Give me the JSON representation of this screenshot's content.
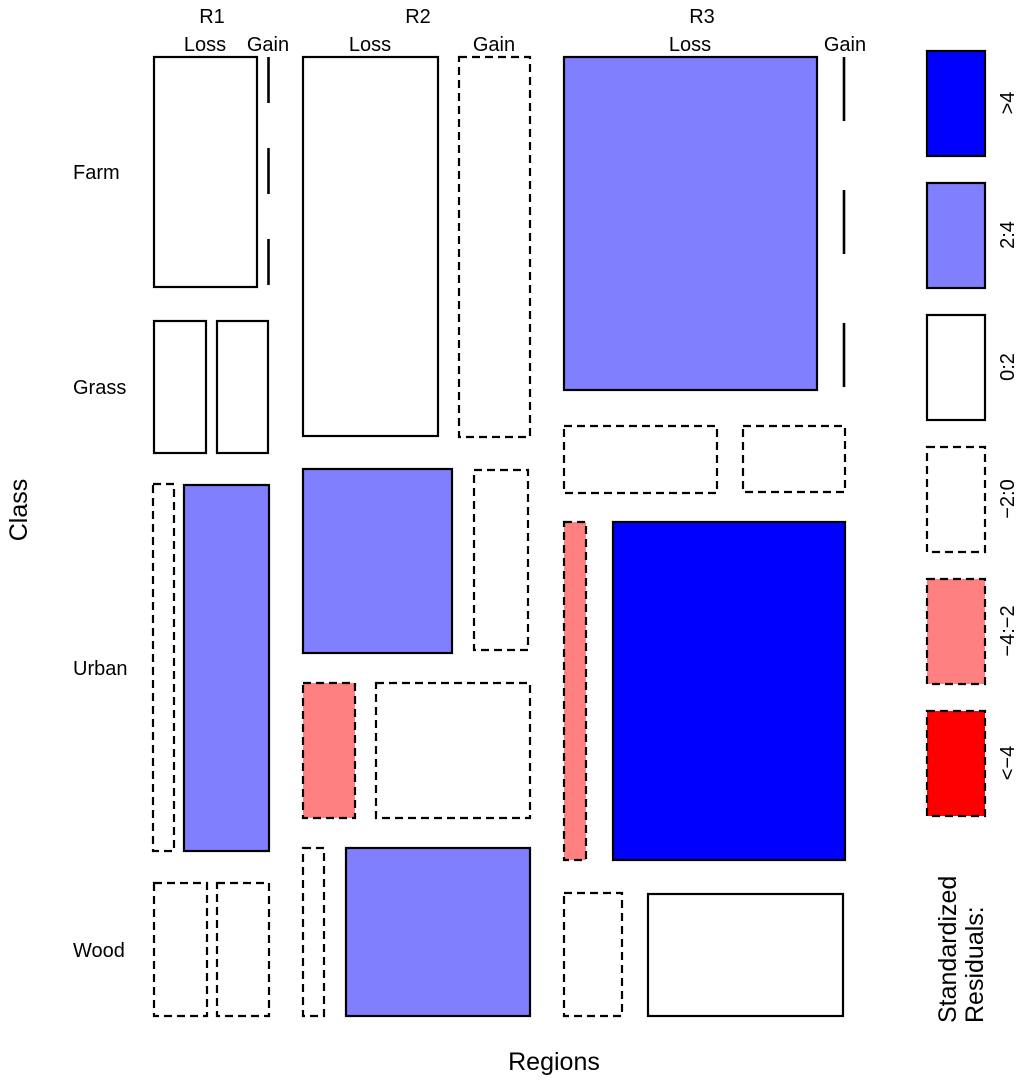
{
  "axes": {
    "x_title": "Regions",
    "y_title": "Class"
  },
  "labels": {
    "columns": [
      {
        "label": "R1",
        "x": 212,
        "y": 23,
        "subs": [
          {
            "label": "Loss",
            "x": 205,
            "y": 51
          },
          {
            "label": "Gain",
            "x": 268,
            "y": 51
          }
        ]
      },
      {
        "label": "R2",
        "x": 418,
        "y": 23,
        "subs": [
          {
            "label": "Loss",
            "x": 370,
            "y": 51
          },
          {
            "label": "Gain",
            "x": 494,
            "y": 51
          }
        ]
      },
      {
        "label": "R3",
        "x": 702,
        "y": 23,
        "subs": [
          {
            "label": "Loss",
            "x": 690,
            "y": 51
          },
          {
            "label": "Gain",
            "x": 845,
            "y": 51
          }
        ]
      }
    ],
    "rows": [
      {
        "label": "Farm",
        "x": 73,
        "y": 179
      },
      {
        "label": "Grass",
        "x": 73,
        "y": 394
      },
      {
        "label": "Urban",
        "x": 73,
        "y": 675
      },
      {
        "label": "Wood",
        "x": 73,
        "y": 957
      }
    ]
  },
  "legend": {
    "title_line1": "Standardized",
    "title_line2": "Residuals:",
    "box_x": 927,
    "box_w": 58,
    "box_h": 105,
    "label_x": 1007,
    "items": [
      {
        "label": ">4",
        "fill": "#0000FF",
        "border": "solid",
        "y": 51,
        "label_cy": 103
      },
      {
        "label": "2:4",
        "fill": "#8080FF",
        "border": "solid",
        "y": 183,
        "label_cy": 235
      },
      {
        "label": "0:2",
        "fill": "#FFFFFF",
        "border": "solid",
        "y": 315,
        "label_cy": 367
      },
      {
        "label": "−2:0",
        "fill": "#FFFFFF",
        "border": "dashed",
        "y": 447,
        "label_cy": 499
      },
      {
        "label": "−4:−2",
        "fill": "#FF8080",
        "border": "dashed",
        "y": 579,
        "label_cy": 631
      },
      {
        "label": "<−4",
        "fill": "#FF0000",
        "border": "dashed",
        "y": 711,
        "label_cy": 763
      }
    ]
  },
  "colors": {
    "residual_gt4": "#0000FF",
    "residual_2_4": "#8080FF",
    "residual_0_2": "#FFFFFF",
    "residual_m2_0": "#FFFFFF",
    "residual_m4_m2": "#FF8080",
    "residual_ltm4": "#FF0000",
    "stroke": "#000000",
    "background": "#FFFFFF"
  },
  "chart_data": {
    "type": "mosaic",
    "x_dimension": "Regions",
    "x_categories": [
      "R1",
      "R2",
      "R3"
    ],
    "sub_categories": [
      "Loss",
      "Gain"
    ],
    "y_dimension": "Class",
    "y_categories": [
      "Farm",
      "Grass",
      "Urban",
      "Wood"
    ],
    "shading": "standardized residuals (solid border = positive, dashed border = negative, long-dash line = zero-width/empty cell)",
    "cells": [
      {
        "region": "R1",
        "class": "Farm",
        "change": "Loss",
        "residual_bin": "0:2",
        "x": 154,
        "y": 57,
        "w": 103,
        "h": 230,
        "fill": "#FFFFFF",
        "border": "solid"
      },
      {
        "region": "R1",
        "class": "Farm",
        "change": "Gain",
        "residual_bin": "zero",
        "zero": true,
        "x": 268.5,
        "y": 57,
        "h": 230,
        "dash": "46 45"
      },
      {
        "region": "R1",
        "class": "Grass",
        "change": "Loss",
        "residual_bin": "0:2",
        "x": 154,
        "y": 321,
        "w": 52,
        "h": 132,
        "fill": "#FFFFFF",
        "border": "solid"
      },
      {
        "region": "R1",
        "class": "Grass",
        "change": "Gain",
        "residual_bin": "0:2",
        "x": 217,
        "y": 321,
        "w": 51,
        "h": 132,
        "fill": "#FFFFFF",
        "border": "solid"
      },
      {
        "region": "R1",
        "class": "Urban",
        "change": "Loss",
        "residual_bin": "−2:0",
        "x": 153,
        "y": 484,
        "w": 21,
        "h": 367,
        "fill": "#FFFFFF",
        "border": "dashed"
      },
      {
        "region": "R1",
        "class": "Urban",
        "change": "Gain",
        "residual_bin": "2:4",
        "x": 184,
        "y": 485,
        "w": 85,
        "h": 366,
        "fill": "#8080FF",
        "border": "solid"
      },
      {
        "region": "R1",
        "class": "Wood",
        "change": "Loss",
        "residual_bin": "−2:0",
        "x": 154,
        "y": 883,
        "w": 53,
        "h": 133,
        "fill": "#FFFFFF",
        "border": "dashed"
      },
      {
        "region": "R1",
        "class": "Wood",
        "change": "Gain",
        "residual_bin": "−2:0",
        "x": 217,
        "y": 883,
        "w": 52,
        "h": 133,
        "fill": "#FFFFFF",
        "border": "dashed"
      },
      {
        "region": "R2",
        "class": "Farm",
        "change": "Loss",
        "residual_bin": "0:2",
        "x": 303,
        "y": 57,
        "w": 135,
        "h": 379,
        "fill": "#FFFFFF",
        "border": "solid"
      },
      {
        "region": "R2",
        "class": "Farm",
        "change": "Gain",
        "residual_bin": "−2:0",
        "x": 459,
        "y": 57,
        "w": 71,
        "h": 380,
        "fill": "#FFFFFF",
        "border": "dashed"
      },
      {
        "region": "R2",
        "class": "Grass",
        "change": "Loss",
        "residual_bin": "2:4",
        "x": 303,
        "y": 469,
        "w": 149,
        "h": 184,
        "fill": "#8080FF",
        "border": "solid"
      },
      {
        "region": "R2",
        "class": "Grass",
        "change": "Gain",
        "residual_bin": "−2:0",
        "x": 474,
        "y": 470,
        "w": 54,
        "h": 180,
        "fill": "#FFFFFF",
        "border": "dashed"
      },
      {
        "region": "R2",
        "class": "Urban",
        "change": "Loss",
        "residual_bin": "−4:−2",
        "x": 303,
        "y": 683,
        "w": 52,
        "h": 135,
        "fill": "#FF8080",
        "border": "dashed"
      },
      {
        "region": "R2",
        "class": "Urban",
        "change": "Gain",
        "residual_bin": "−2:0",
        "x": 376,
        "y": 683,
        "w": 154,
        "h": 135,
        "fill": "#FFFFFF",
        "border": "dashed"
      },
      {
        "region": "R2",
        "class": "Wood",
        "change": "Loss",
        "residual_bin": "−2:0",
        "x": 303,
        "y": 848,
        "w": 21,
        "h": 168,
        "fill": "#FFFFFF",
        "border": "dashed"
      },
      {
        "region": "R2",
        "class": "Wood",
        "change": "Gain",
        "residual_bin": "2:4",
        "x": 346,
        "y": 848,
        "w": 184,
        "h": 168,
        "fill": "#8080FF",
        "border": "solid"
      },
      {
        "region": "R3",
        "class": "Farm",
        "change": "Loss",
        "residual_bin": "2:4",
        "x": 564,
        "y": 57,
        "w": 253,
        "h": 333,
        "fill": "#8080FF",
        "border": "solid"
      },
      {
        "region": "R3",
        "class": "Farm",
        "change": "Gain",
        "residual_bin": "zero",
        "zero": true,
        "x": 844,
        "y": 57,
        "h": 331,
        "dash": "64 69"
      },
      {
        "region": "R3",
        "class": "Grass",
        "change": "Loss",
        "residual_bin": "−2:0",
        "x": 564,
        "y": 426,
        "w": 153,
        "h": 67,
        "fill": "#FFFFFF",
        "border": "dashed"
      },
      {
        "region": "R3",
        "class": "Grass",
        "change": "Gain",
        "residual_bin": "−2:0",
        "x": 743,
        "y": 426,
        "w": 102,
        "h": 66,
        "fill": "#FFFFFF",
        "border": "dashed"
      },
      {
        "region": "R3",
        "class": "Urban",
        "change": "Loss",
        "residual_bin": "−4:−2",
        "x": 564,
        "y": 522,
        "w": 22,
        "h": 338,
        "fill": "#FF8080",
        "border": "dashed"
      },
      {
        "region": "R3",
        "class": "Urban",
        "change": "Gain",
        "residual_bin": ">4",
        "x": 613,
        "y": 522,
        "w": 232,
        "h": 338,
        "fill": "#0000FF",
        "border": "solid"
      },
      {
        "region": "R3",
        "class": "Wood",
        "change": "Loss",
        "residual_bin": "−2:0",
        "x": 564,
        "y": 893,
        "w": 58,
        "h": 123,
        "fill": "#FFFFFF",
        "border": "dashed"
      },
      {
        "region": "R3",
        "class": "Wood",
        "change": "Gain",
        "residual_bin": "0:2",
        "x": 648,
        "y": 894,
        "w": 195,
        "h": 122,
        "fill": "#FFFFFF",
        "border": "solid"
      }
    ]
  }
}
